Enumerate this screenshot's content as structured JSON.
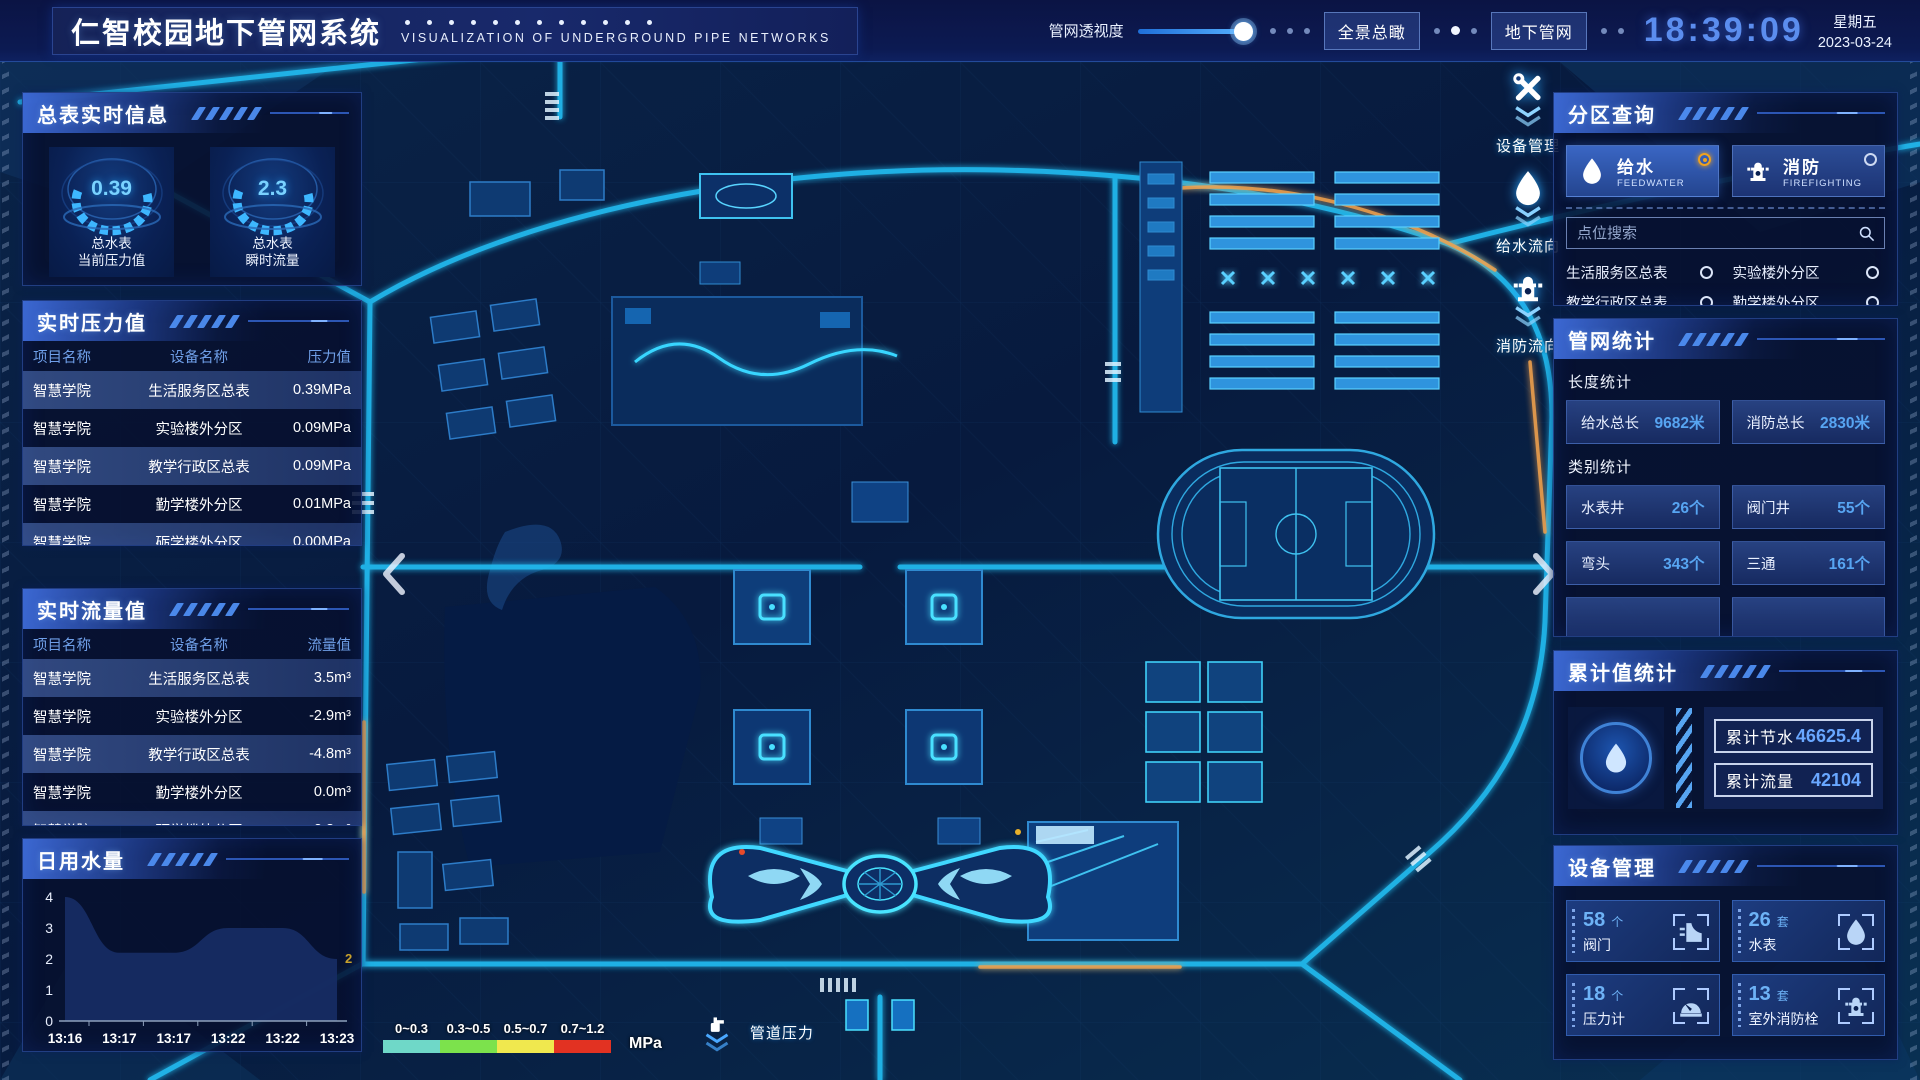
{
  "header": {
    "title": "仁智校园地下管网系统",
    "subtitle": "VISUALIZATION OF UNDERGROUND PIPE NETWORKS",
    "opacity_label": "管网透视度",
    "overview_btn": "全景总瞰",
    "underground_btn": "地下管网",
    "time": "18:39:09",
    "weekday": "星期五",
    "date": "2023-03-24"
  },
  "meter_info": {
    "title": "总表实时信息",
    "gauges": [
      {
        "value": "0.39",
        "line1": "总水表",
        "line2": "当前压力值"
      },
      {
        "value": "2.3",
        "line1": "总水表",
        "line2": "瞬时流量"
      }
    ]
  },
  "pressure_table": {
    "title": "实时压力值",
    "headers": {
      "project": "项目名称",
      "device": "设备名称",
      "value": "压力值"
    },
    "rows": [
      {
        "project": "智慧学院",
        "device": "生活服务区总表",
        "value": "0.39MPa"
      },
      {
        "project": "智慧学院",
        "device": "实验楼外分区",
        "value": "0.09MPa"
      },
      {
        "project": "智慧学院",
        "device": "教学行政区总表",
        "value": "0.09MPa"
      },
      {
        "project": "智慧学院",
        "device": "勤学楼外分区",
        "value": "0.01MPa"
      },
      {
        "project": "智慧学院",
        "device": "砺学楼外分区",
        "value": "0.00MPa"
      }
    ]
  },
  "flow_table": {
    "title": "实时流量值",
    "headers": {
      "project": "项目名称",
      "device": "设备名称",
      "value": "流量值"
    },
    "rows": [
      {
        "project": "智慧学院",
        "device": "生活服务区总表",
        "value": "3.5m³"
      },
      {
        "project": "智慧学院",
        "device": "实验楼外分区",
        "value": "-2.9m³"
      },
      {
        "project": "智慧学院",
        "device": "教学行政区总表",
        "value": "-4.8m³"
      },
      {
        "project": "智慧学院",
        "device": "勤学楼外分区",
        "value": "0.0m³"
      },
      {
        "project": "智慧学院",
        "device": "砺学楼外分区",
        "value": "2.3m³"
      }
    ]
  },
  "daily_chart": {
    "title": "日用水量"
  },
  "chart_data": {
    "type": "area",
    "title": "日用水量",
    "x": [
      "13:16",
      "13:17",
      "13:17",
      "13:22",
      "13:22",
      "13:23"
    ],
    "values": [
      4,
      2.2,
      2.2,
      3,
      3,
      2
    ],
    "yticks": [
      0,
      1,
      2,
      3,
      4
    ],
    "ylim": [
      0,
      4
    ],
    "xlabel": "",
    "ylabel": "",
    "last_value_label": "2",
    "fill_color": "#162c63",
    "label_color": "#c8a12c",
    "legend_position": "none",
    "grid": false
  },
  "zone_query": {
    "title": "分区查询",
    "tabs": [
      {
        "label": "给水",
        "sub": "FEEDWATER",
        "selected": "true",
        "icon": "icon-drop"
      },
      {
        "label": "消防",
        "sub": "FIREFIGHTING",
        "selected": "false",
        "icon": "icon-hydrant"
      }
    ],
    "search_placeholder": "点位搜索",
    "zones": [
      {
        "label": "生活服务区总表"
      },
      {
        "label": "实验楼外分区"
      },
      {
        "label": "教学行政区总表"
      },
      {
        "label": "勤学楼外分区"
      },
      {
        "label": "砺学楼外分区"
      },
      {
        "label": "宿舍区泵房"
      }
    ]
  },
  "pipe_stats": {
    "title": "管网统计",
    "length_title": "长度统计",
    "length_stats": [
      {
        "label": "给水总长",
        "value": "9682米"
      },
      {
        "label": "消防总长",
        "value": "2830米"
      }
    ],
    "category_title": "类别统计",
    "category_stats": [
      {
        "label": "水表井",
        "value": "26个"
      },
      {
        "label": "阀门井",
        "value": "55个"
      },
      {
        "label": "弯头",
        "value": "343个"
      },
      {
        "label": "三通",
        "value": "161个"
      },
      {
        "label": "",
        "value": ""
      },
      {
        "label": "",
        "value": ""
      }
    ]
  },
  "cumulative": {
    "title": "累计值统计",
    "rows": [
      {
        "label": "累计节水",
        "value": "46625.4"
      },
      {
        "label": "累计流量",
        "value": "42104"
      }
    ]
  },
  "devices": {
    "title": "设备管理",
    "cards": [
      {
        "count": "58",
        "unit": "个",
        "name": "阀门",
        "icon": "icon-valve"
      },
      {
        "count": "26",
        "unit": "套",
        "name": "水表",
        "icon": "icon-drop"
      },
      {
        "count": "18",
        "unit": "个",
        "name": "压力计",
        "icon": "icon-gauge"
      },
      {
        "count": "13",
        "unit": "套",
        "name": "室外消防栓",
        "icon": "icon-hydrant"
      }
    ]
  },
  "map_overlay": {
    "float_buttons": [
      {
        "label": "设备管理",
        "icon": "icon-tools"
      },
      {
        "label": "给水流向",
        "icon": "icon-drop"
      },
      {
        "label": "消防流向",
        "icon": "icon-hydrant"
      }
    ],
    "legend": {
      "ranges": [
        {
          "label": "0~0.3",
          "color": "#6fd8c8"
        },
        {
          "label": "0.3~0.5",
          "color": "#7ce24c"
        },
        {
          "label": "0.5~0.7",
          "color": "#f0e84e"
        },
        {
          "label": "0.7~1.2",
          "color": "#e23222"
        }
      ],
      "unit": "MPa",
      "label": "管道压力"
    }
  },
  "colors": {
    "accent_cyan": "#2fd2ff",
    "accent_blue": "#57a5f2",
    "selected_radio_orange": "#f0a21e",
    "clock_blue": "#5b8dee"
  }
}
